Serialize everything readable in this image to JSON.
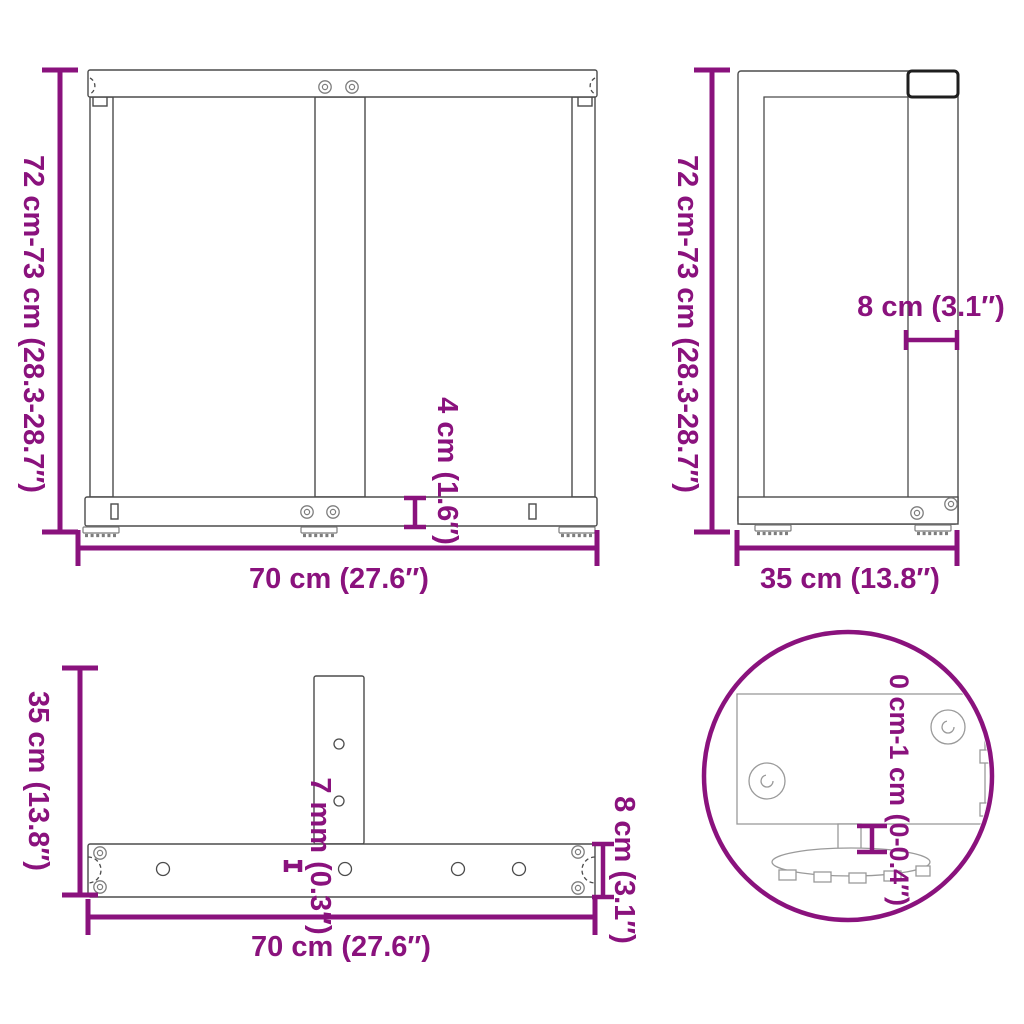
{
  "colors": {
    "accent": "#8A127D",
    "line": "#4b4b4b",
    "line_light": "#9a9a9a",
    "dark": "#1e1e1e"
  },
  "views": {
    "front": {
      "height_label": "72 cm-73 cm (28.3-28.7″)",
      "width_label": "70 cm (27.6″)",
      "bar_height_label": "4 cm (1.6″)"
    },
    "side": {
      "height_label": "72 cm-73 cm (28.3-28.7″)",
      "depth_label": "35 cm (13.8″)",
      "leg_width_label": "8 cm (3.1″)"
    },
    "top": {
      "depth_label": "35 cm (13.8″)",
      "width_label": "70 cm (27.6″)",
      "thickness_label": "7 mm (0.3″)",
      "bar_width_label": "8 cm (3.1″)"
    },
    "detail": {
      "adjust_label": "0 cm-1 cm (0-0.4″)"
    }
  }
}
